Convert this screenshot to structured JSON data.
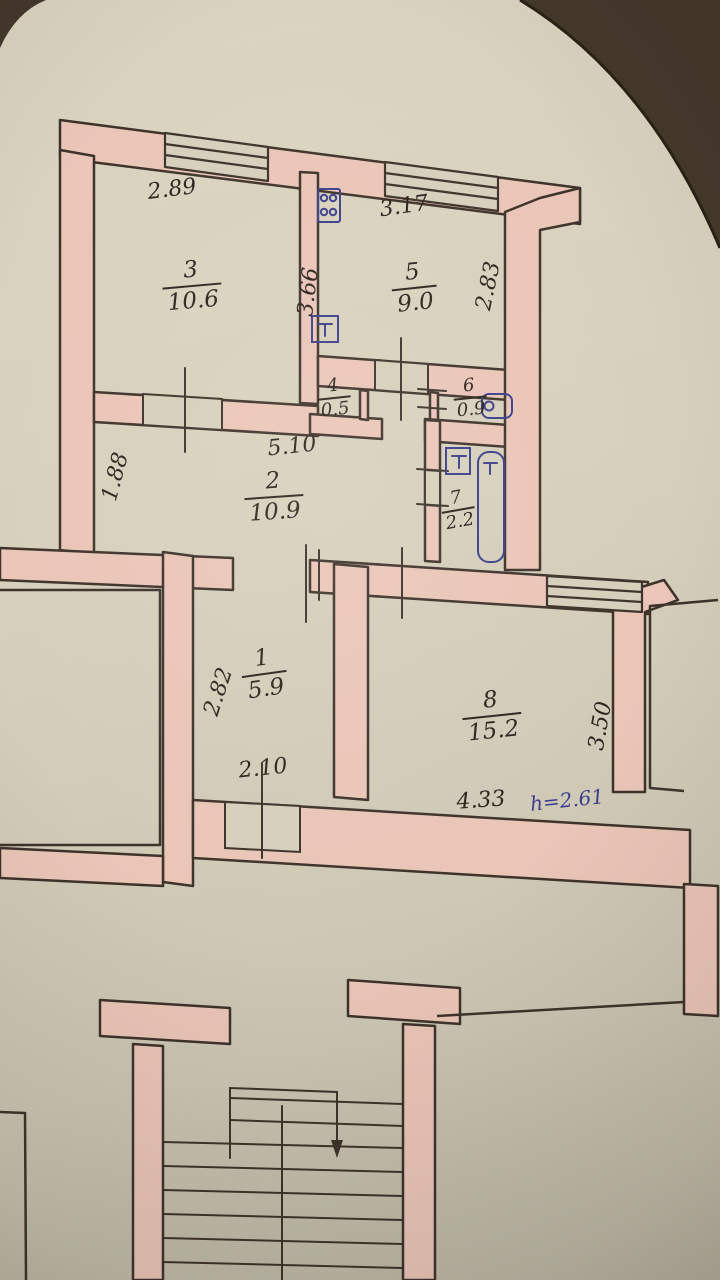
{
  "plan": {
    "rooms": {
      "r1": {
        "number": "1",
        "area": "5.9"
      },
      "r2": {
        "number": "2",
        "area": "10.9"
      },
      "r3": {
        "number": "3",
        "area": "10.6"
      },
      "r4": {
        "number": "4",
        "area": "0.5"
      },
      "r5": {
        "number": "5",
        "area": "9.0"
      },
      "r6": {
        "number": "6",
        "area": "0.9"
      },
      "r7": {
        "number": "7",
        "area": "2.2"
      },
      "r8": {
        "number": "8",
        "area": "15.2"
      }
    },
    "dims": {
      "room3_width": "2.89",
      "room3_depth": "3.66",
      "room5_width": "3.17",
      "room5_depth": "2.83",
      "room2_width": "5.10",
      "room2_depth": "1.88",
      "room1_depth": "2.82",
      "room1_width": "2.10",
      "room8_width": "4.33",
      "room8_depth": "3.50",
      "ceiling_height": "h=2.61"
    },
    "colors": {
      "paper": "#d5cfbb",
      "wall_fill": "#eac5b8",
      "line_ink": "#3e332a",
      "handwriting_ink": "#2b241d",
      "blue_ink": "#3c3e8c",
      "photo_background": "#44382b"
    }
  }
}
